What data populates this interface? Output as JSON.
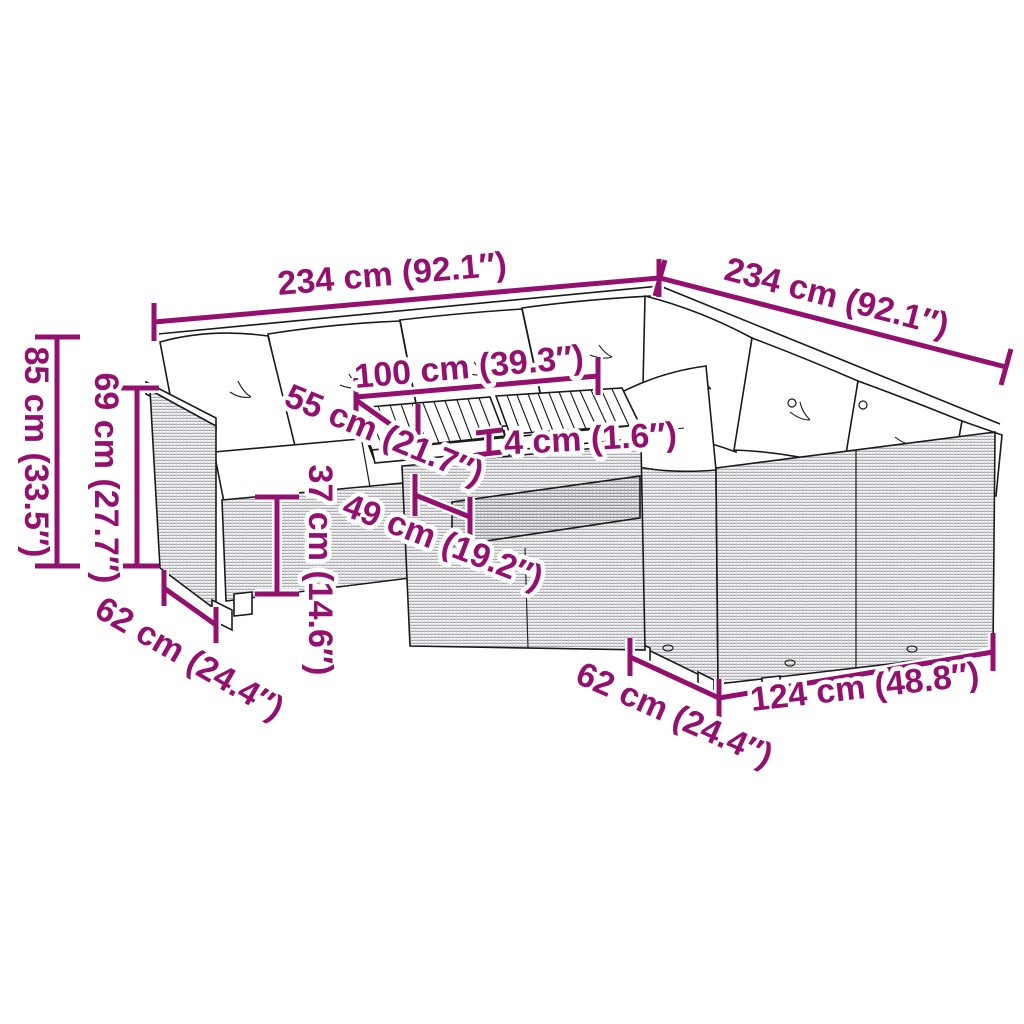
{
  "meta": {
    "title": "Garden rattan corner sofa set with table - dimension diagram",
    "background_color": "#ffffff",
    "accent_color": "#94106E",
    "line_color": "#1a1a1a"
  },
  "dims": {
    "left_width": "234 cm (92.1″)",
    "right_width": "234 cm (92.1″)",
    "table_length": "100 cm (39.3″)",
    "table_depth": "55 cm (21.7″)",
    "tabletop_thickness": "4 cm (1.6″)",
    "seat_height": "37 cm (14.6″)",
    "table_height": "49 cm (19.2″)",
    "total_height": "85 cm (33.5″)",
    "backrest_height": "69 cm (27.7″)",
    "seat_depth_left": "62 cm (24.4″)",
    "seat_depth_right": "62 cm (24.4″)",
    "sofa_module_length": "124 cm (48.8″)"
  }
}
